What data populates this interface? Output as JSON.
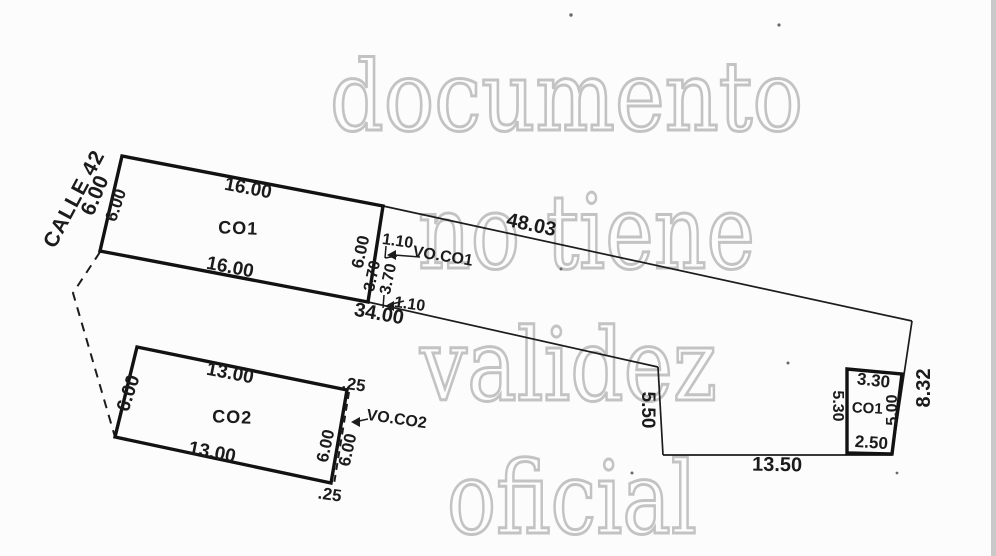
{
  "watermark": {
    "words": [
      "documento",
      "no tiene",
      "validez",
      "oficial"
    ],
    "color": "#c3c3c3"
  },
  "street": {
    "name": "CALLE 42",
    "frontage": "6.00"
  },
  "boundary": {
    "north_length": "48.03",
    "mid_length": "34.00",
    "step_length": "5.50",
    "south_length": "13.50",
    "east_length": "8.32"
  },
  "construction_co1": {
    "name": "CO1",
    "north": "16.00",
    "south": "16.00",
    "west": "6.00",
    "east": "6.00"
  },
  "void_co1": {
    "name": "VO.CO1",
    "top_offset": "1.10",
    "bottom_offset": "1.10",
    "depth_left": "3.70",
    "depth_right": "3.70"
  },
  "construction_co2": {
    "name": "CO2",
    "north": "13.00",
    "south": "13.00",
    "west": "6.00",
    "east_inner": "6.00",
    "east_outer": "6.00",
    "offset_top": ".25",
    "offset_bottom": ".25"
  },
  "void_co2": {
    "name": "VO.CO2"
  },
  "construction_co1_annex": {
    "name": "CO1",
    "north": "3.30",
    "west": "5.30",
    "east": "5.00",
    "south": "2.50"
  },
  "colors": {
    "ink": "#1b1b1b",
    "paper": "#fcfcfc",
    "scan_edge": "#c9c9c9"
  }
}
